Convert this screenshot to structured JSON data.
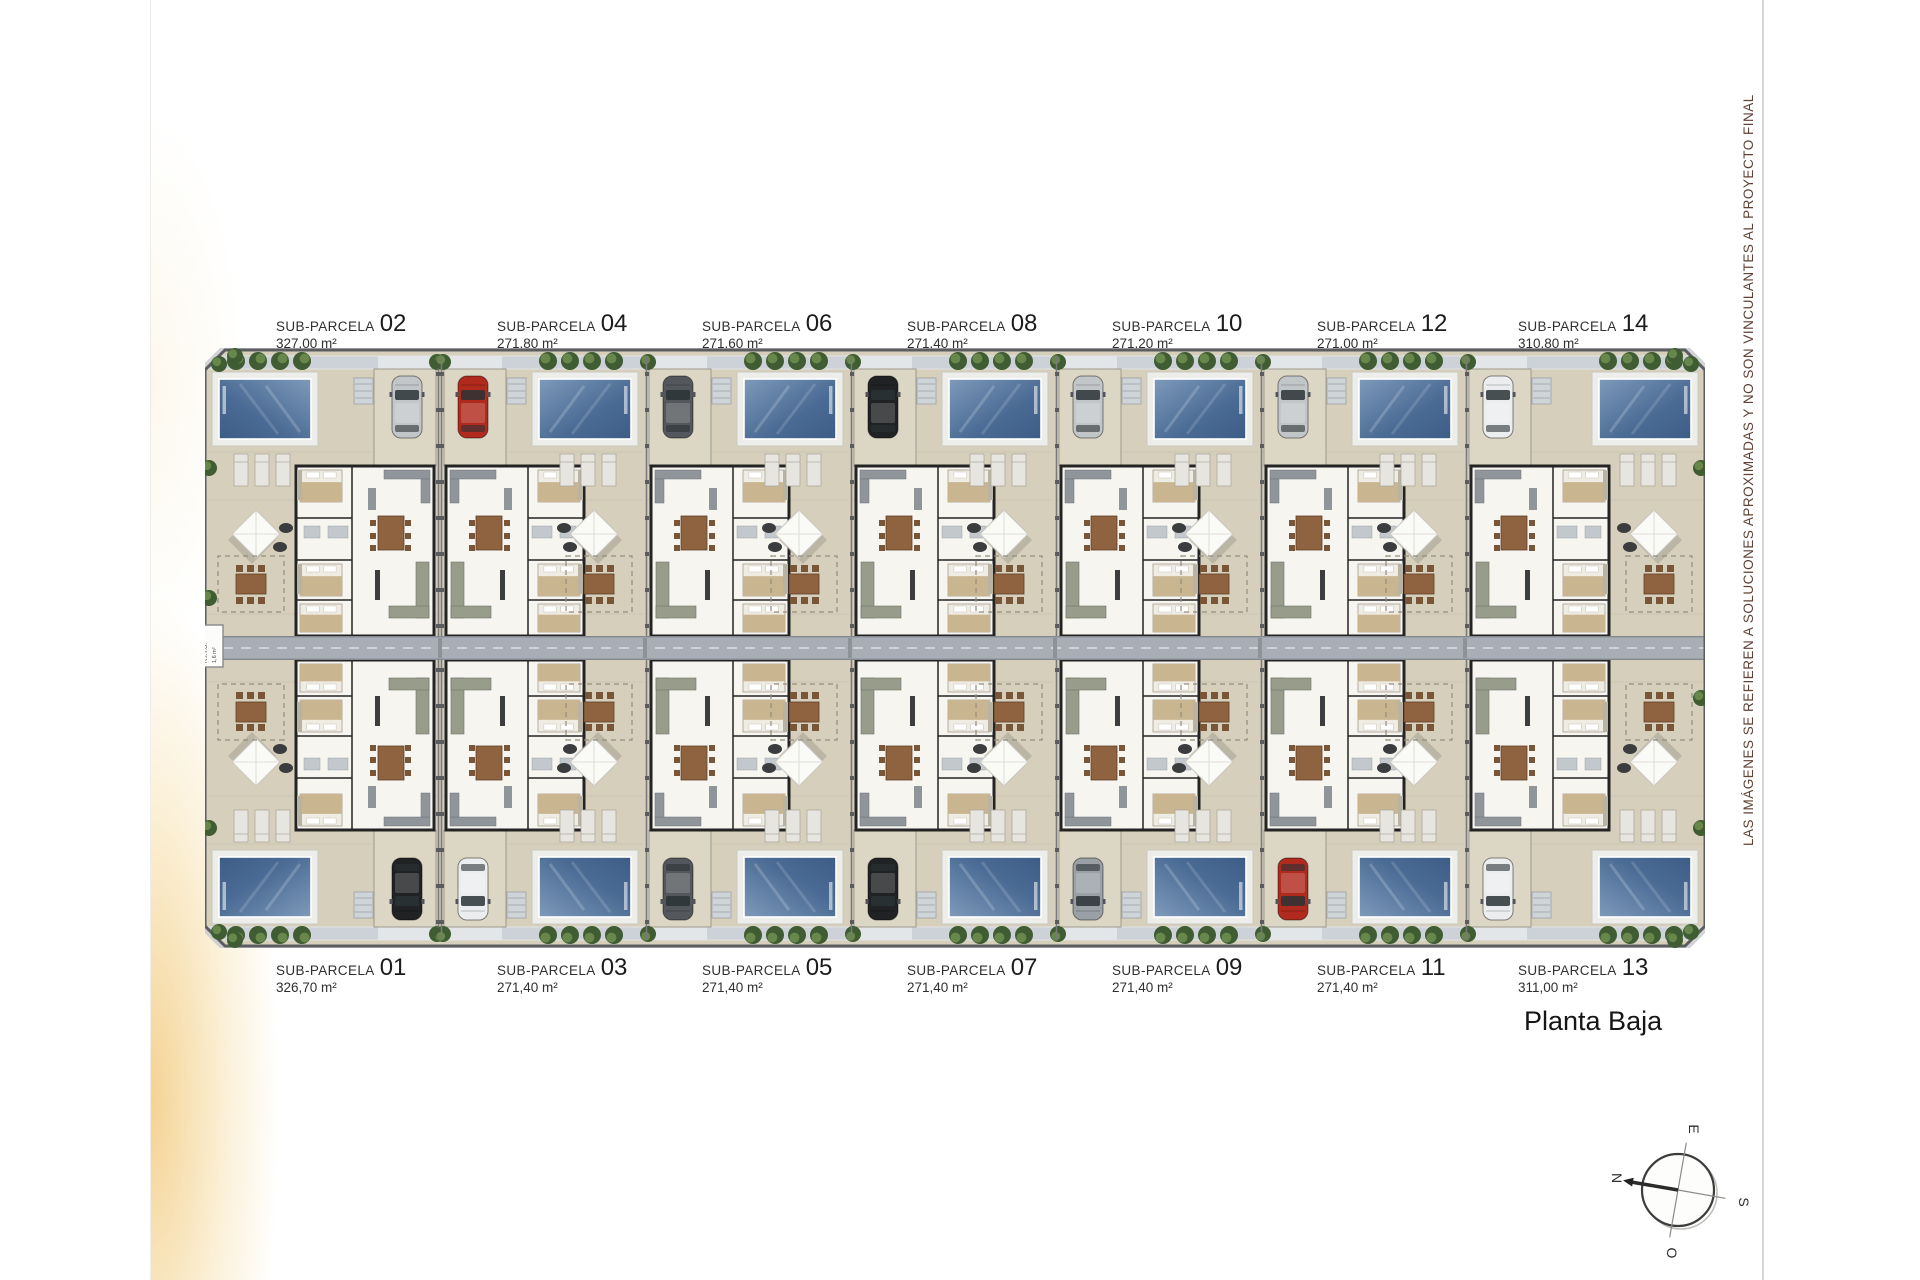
{
  "page": {
    "disclaimer": "LAS IMÁGENES SE REFIEREN A SOLUCIONES APROXIMADAS Y NO SON VINCULANTES AL PROYECTO FINAL",
    "floor_label": "Planta Baja",
    "ritu_label": "R.I.T.U.",
    "ritu_area": "1,6 m²"
  },
  "parcel_label_prefix": "SUB-PARCELA",
  "compass": {
    "north": "N",
    "east": "E",
    "south": "S",
    "west": "O"
  },
  "parcels": [
    {
      "number": "01",
      "area": "326,70 m²",
      "row": "bottom",
      "col": 0,
      "car_color": "black"
    },
    {
      "number": "02",
      "area": "327,00 m²",
      "row": "top",
      "col": 0,
      "car_color": "silver"
    },
    {
      "number": "03",
      "area": "271,40 m²",
      "row": "bottom",
      "col": 1,
      "car_color": "white"
    },
    {
      "number": "04",
      "area": "271,80 m²",
      "row": "top",
      "col": 1,
      "car_color": "red"
    },
    {
      "number": "05",
      "area": "271,40 m²",
      "row": "bottom",
      "col": 2,
      "car_color": "darkgray"
    },
    {
      "number": "06",
      "area": "271,60 m²",
      "row": "top",
      "col": 2,
      "car_color": "darkgray"
    },
    {
      "number": "07",
      "area": "271,40 m²",
      "row": "bottom",
      "col": 3,
      "car_color": "black"
    },
    {
      "number": "08",
      "area": "271,40 m²",
      "row": "top",
      "col": 3,
      "car_color": "black"
    },
    {
      "number": "09",
      "area": "271,40 m²",
      "row": "bottom",
      "col": 4,
      "car_color": "gray"
    },
    {
      "number": "10",
      "area": "271,20 m²",
      "row": "top",
      "col": 4,
      "car_color": "silver"
    },
    {
      "number": "11",
      "area": "271,40 m²",
      "row": "bottom",
      "col": 5,
      "car_color": "red"
    },
    {
      "number": "12",
      "area": "271,00 m²",
      "row": "top",
      "col": 5,
      "car_color": "silver"
    },
    {
      "number": "13",
      "area": "311,00 m²",
      "row": "bottom",
      "col": 6,
      "car_color": "white"
    },
    {
      "number": "14",
      "area": "310,80 m²",
      "row": "top",
      "col": 6,
      "car_color": "white"
    }
  ],
  "palette": {
    "ground": "#d6cfbc",
    "ground_light": "#dcd6c5",
    "walkway": "#ccd2d8",
    "walkway_gap": "#e3e6e9",
    "deck": "#edeeea",
    "pool_light": "#7e9aba",
    "pool_dark": "#3d5d86",
    "road": "#a9aeb6",
    "road_edge": "#83878e",
    "tree_dark": "#3f5c33",
    "tree_light": "#6f8f4f",
    "wall": "#242424",
    "floor": "#f7f5f0",
    "sofa": "#979c8b",
    "wood": "#8f6340",
    "chair_wood": "#7a5638",
    "bed_tan": "#c9b691",
    "counter": "#90959a",
    "boundary": "#5b5d60",
    "sidewalk": "#c6c8ca",
    "fence": "#77797c",
    "label_text": "#2f2f2f",
    "disclaimer_text": "#5f4136",
    "gold": "#f0c470"
  },
  "car_colors": {
    "silver": "#c3c6c9",
    "red": "#b02a1e",
    "darkgray": "#54575b",
    "black": "#202224",
    "white": "#ecedee",
    "gray": "#9aa0a5"
  }
}
